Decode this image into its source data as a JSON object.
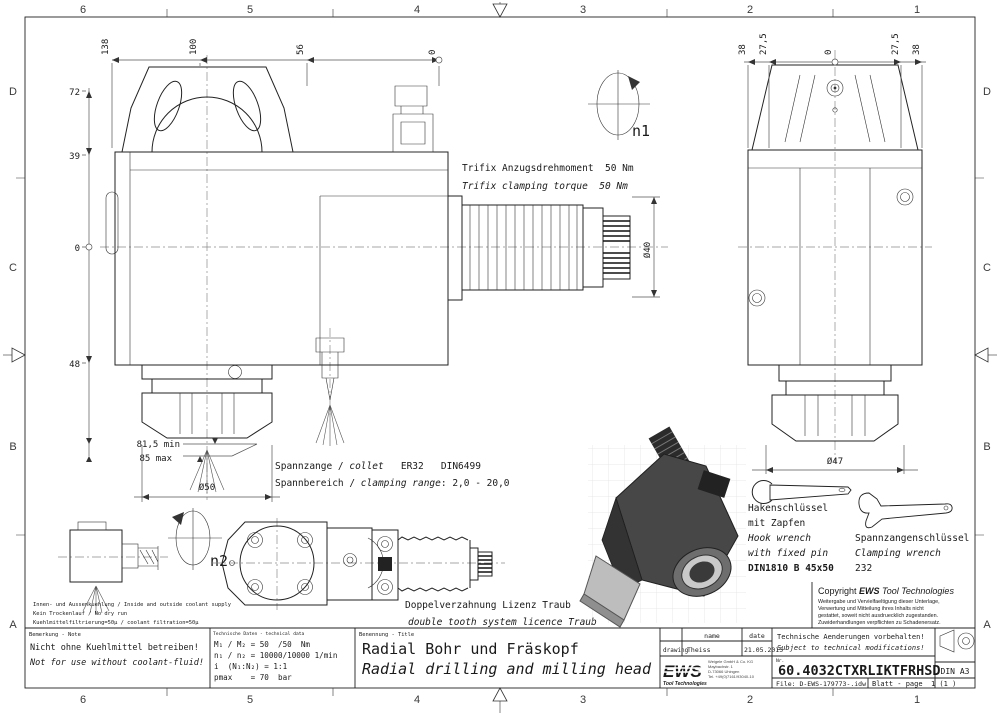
{
  "frame": {
    "cols": [
      "6",
      "5",
      "4",
      "3",
      "2",
      "1"
    ],
    "rows": [
      "D",
      "C",
      "B",
      "A"
    ]
  },
  "main_view": {
    "dims_top": [
      "138",
      "100",
      "56",
      "0"
    ],
    "dims_left": [
      "72",
      "39",
      "0",
      "48"
    ],
    "dim_min": "81,5 min",
    "dim_max": "85 max",
    "dia_collet": "Ø50",
    "dia_spindle": "Ø40",
    "spin": "n1",
    "trifix_de": "Trifix Anzugsdrehmoment  50 Nm",
    "trifix_en": "Trifix clamping torque  50 Nm"
  },
  "side_view": {
    "dims_top": [
      "38",
      "27,5",
      "0",
      "27,5",
      "38"
    ],
    "dia_collet": "Ø47"
  },
  "detail_view": {
    "spin": "n2"
  },
  "collet_note": {
    "de_label": "Spannzange / ",
    "de_italic": "collet",
    "de_value": "   ER32   DIN6499",
    "range_label": "Spannbereich / ",
    "range_italic": "clamping range",
    "range_value": ": 2,0 - 20,0"
  },
  "gear_note": {
    "de": "Doppelverzahnung Lizenz Traub",
    "en": "double tooth system licence Traub"
  },
  "coolant_notes": [
    "Innen- und Aussenkuehlung / Inside and outside coolant supply",
    "Kein Trockenlauf / No dry run",
    "Kuehlmittelfiltrierung=50µ / coolant filtration=50µ"
  ],
  "hook_wrench": {
    "de1": "Hakenschlüssel",
    "de2": "mit Zapfen",
    "en1": "Hook wrench",
    "en2": "with fixed pin",
    "spec": "DIN1810 B 45x50"
  },
  "clamp_wrench": {
    "de": "Spannzangenschlüssel",
    "en": "Clamping wrench",
    "spec": "232"
  },
  "copyright": {
    "prefix": "Copyright ",
    "brand": "EWS",
    "suffix": " Tool Technologies",
    "lines": [
      "Weitergabe und Vervielfaeltigung dieser Unterlage,",
      "Verwertung und Mitteilung ihres Inhalts nicht",
      "gestattet, soweit nicht ausdruecklich zugestanden.",
      "Zuwiderhandlungen verpflichten zu Schadenersatz."
    ]
  },
  "title_block": {
    "note": {
      "header": "Bemerkung - Note",
      "de": "Nicht ohne Kuehlmittel betreiben!",
      "en": "Not for use without coolant-fluid!"
    },
    "tech": {
      "header": "Technische Daten - technical data",
      "rows": [
        "M₁ / M₂ = 50  /50  Nm",
        "n₁ / n₂ = 10000/10000 1/min",
        "i  (N₁:N₂) = 1:1",
        "pmax    = 70  bar"
      ]
    },
    "title": {
      "header": "Benennung - Title",
      "de": "Radial Bohr und Fräskopf",
      "en": "Radial drilling and milling head"
    },
    "revision": {
      "col_name": "name",
      "col_date": "date",
      "row_label": "drawing",
      "row_name": "Theiss",
      "row_date": "21.05.2015"
    },
    "company": {
      "brand": "EWS",
      "sub": "Tool Technologies",
      "lines": [
        "Weigele GmbH & Co. KG",
        "Maybachstr. 1",
        "D-73066 Uhingen",
        "Tel. +49(0)7161/93040-10"
      ]
    },
    "changes": {
      "de": "Technische Aenderungen vorbehalten!",
      "en": "Subject to technical modifications!"
    },
    "number": {
      "label": "Nr.",
      "value": "60.4032CTXRLIKTFRHSD"
    },
    "file": "File: D-EWS-179773-.idw",
    "page": "Blatt - page  1 (1 )",
    "format": "DIN A3"
  }
}
